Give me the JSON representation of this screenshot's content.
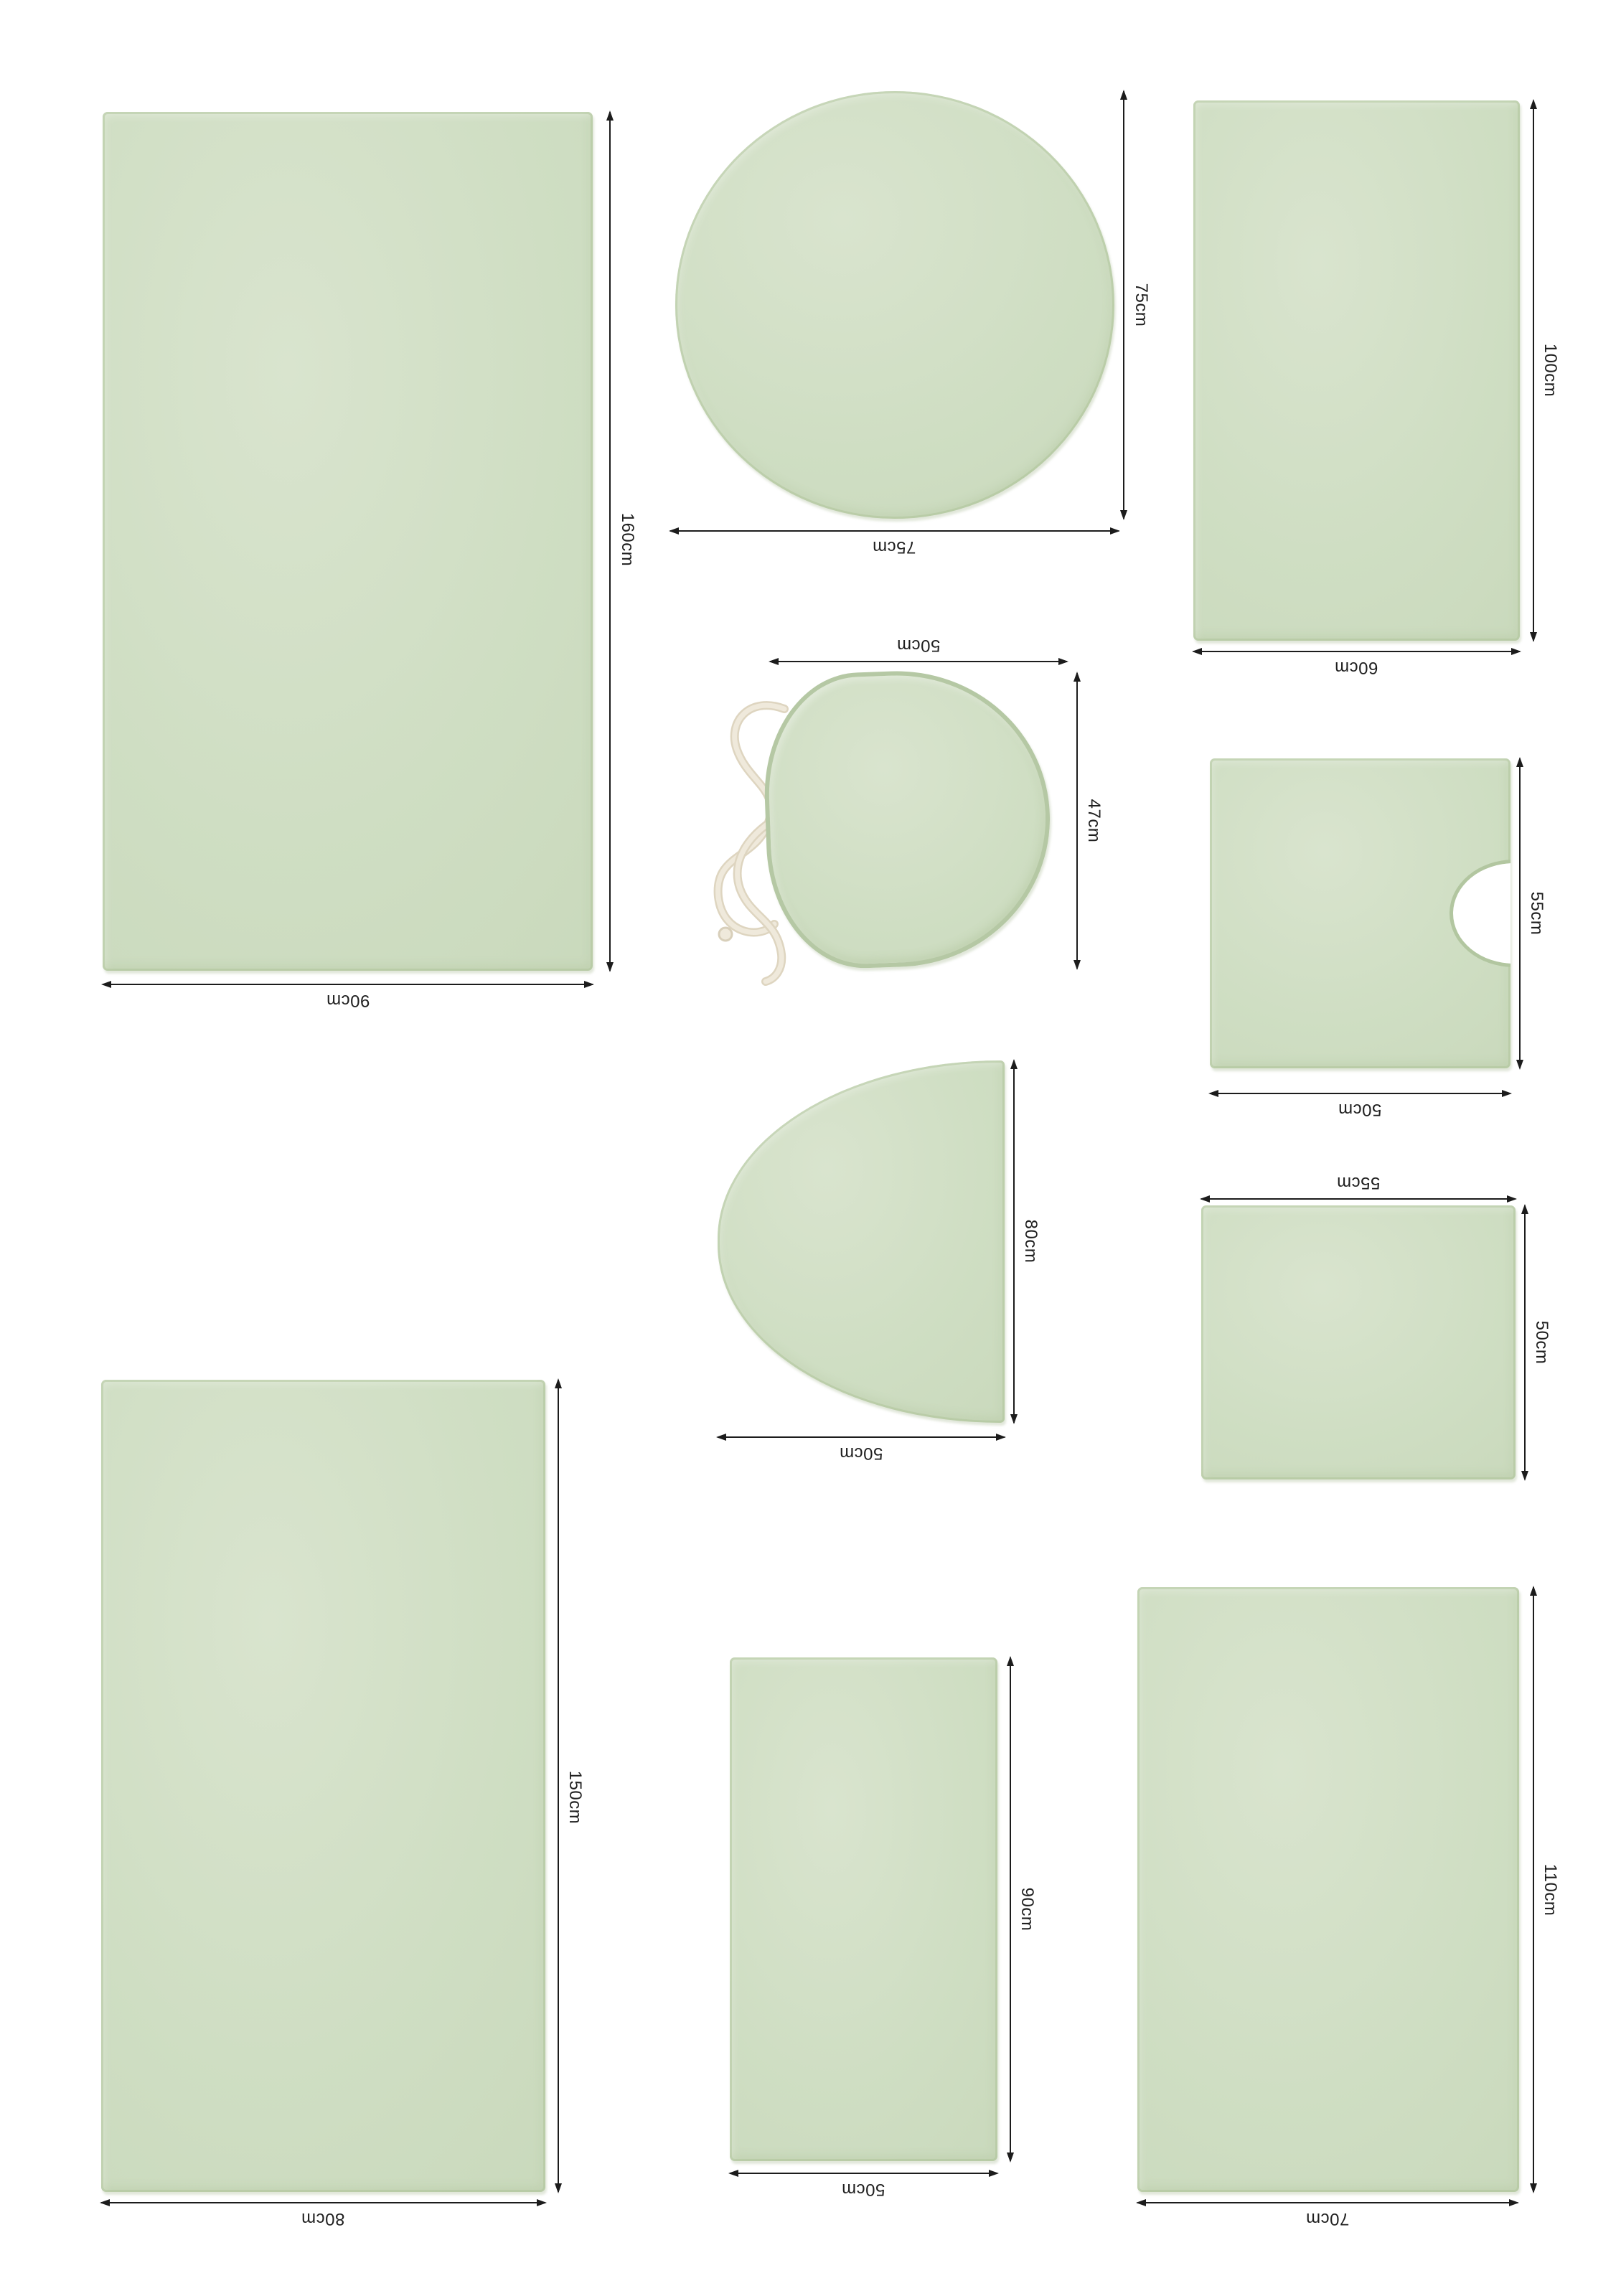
{
  "sheet": {
    "background": "#ffffff",
    "unit": "cm"
  },
  "colors": {
    "rug_fill": "#cfdec3",
    "rug_edge": "#b2c6a0",
    "dimension_line": "#1c1c1c",
    "drawstring": "#ece4d4"
  },
  "products": [
    {
      "id": "rect-mat-90x160",
      "shape": "rectangle",
      "height_label": "160cm",
      "width_label": "90cm"
    },
    {
      "id": "round-mat-75",
      "shape": "circle",
      "height_label": "75cm",
      "width_label": "75cm"
    },
    {
      "id": "rect-mat-60x100",
      "shape": "rectangle",
      "height_label": "100cm",
      "width_label": "60cm"
    },
    {
      "id": "toilet-lid-cover-50x47",
      "shape": "toilet-lid",
      "height_label": "47cm",
      "width_label": "50cm"
    },
    {
      "id": "pedestal-mat-50x55",
      "shape": "pedestal",
      "height_label": "55cm",
      "width_label": "50cm"
    },
    {
      "id": "half-moon-mat-50x80",
      "shape": "half-circle",
      "height_label": "80cm",
      "width_label": "50cm"
    },
    {
      "id": "square-mat-55x50",
      "shape": "square",
      "height_label": "50cm",
      "width_label": "55cm"
    },
    {
      "id": "rect-mat-80x150",
      "shape": "rectangle",
      "height_label": "150cm",
      "width_label": "80cm"
    },
    {
      "id": "rect-mat-50x90",
      "shape": "rectangle",
      "height_label": "90cm",
      "width_label": "50cm"
    },
    {
      "id": "rect-mat-70x110",
      "shape": "rectangle",
      "height_label": "110cm",
      "width_label": "70cm"
    }
  ]
}
